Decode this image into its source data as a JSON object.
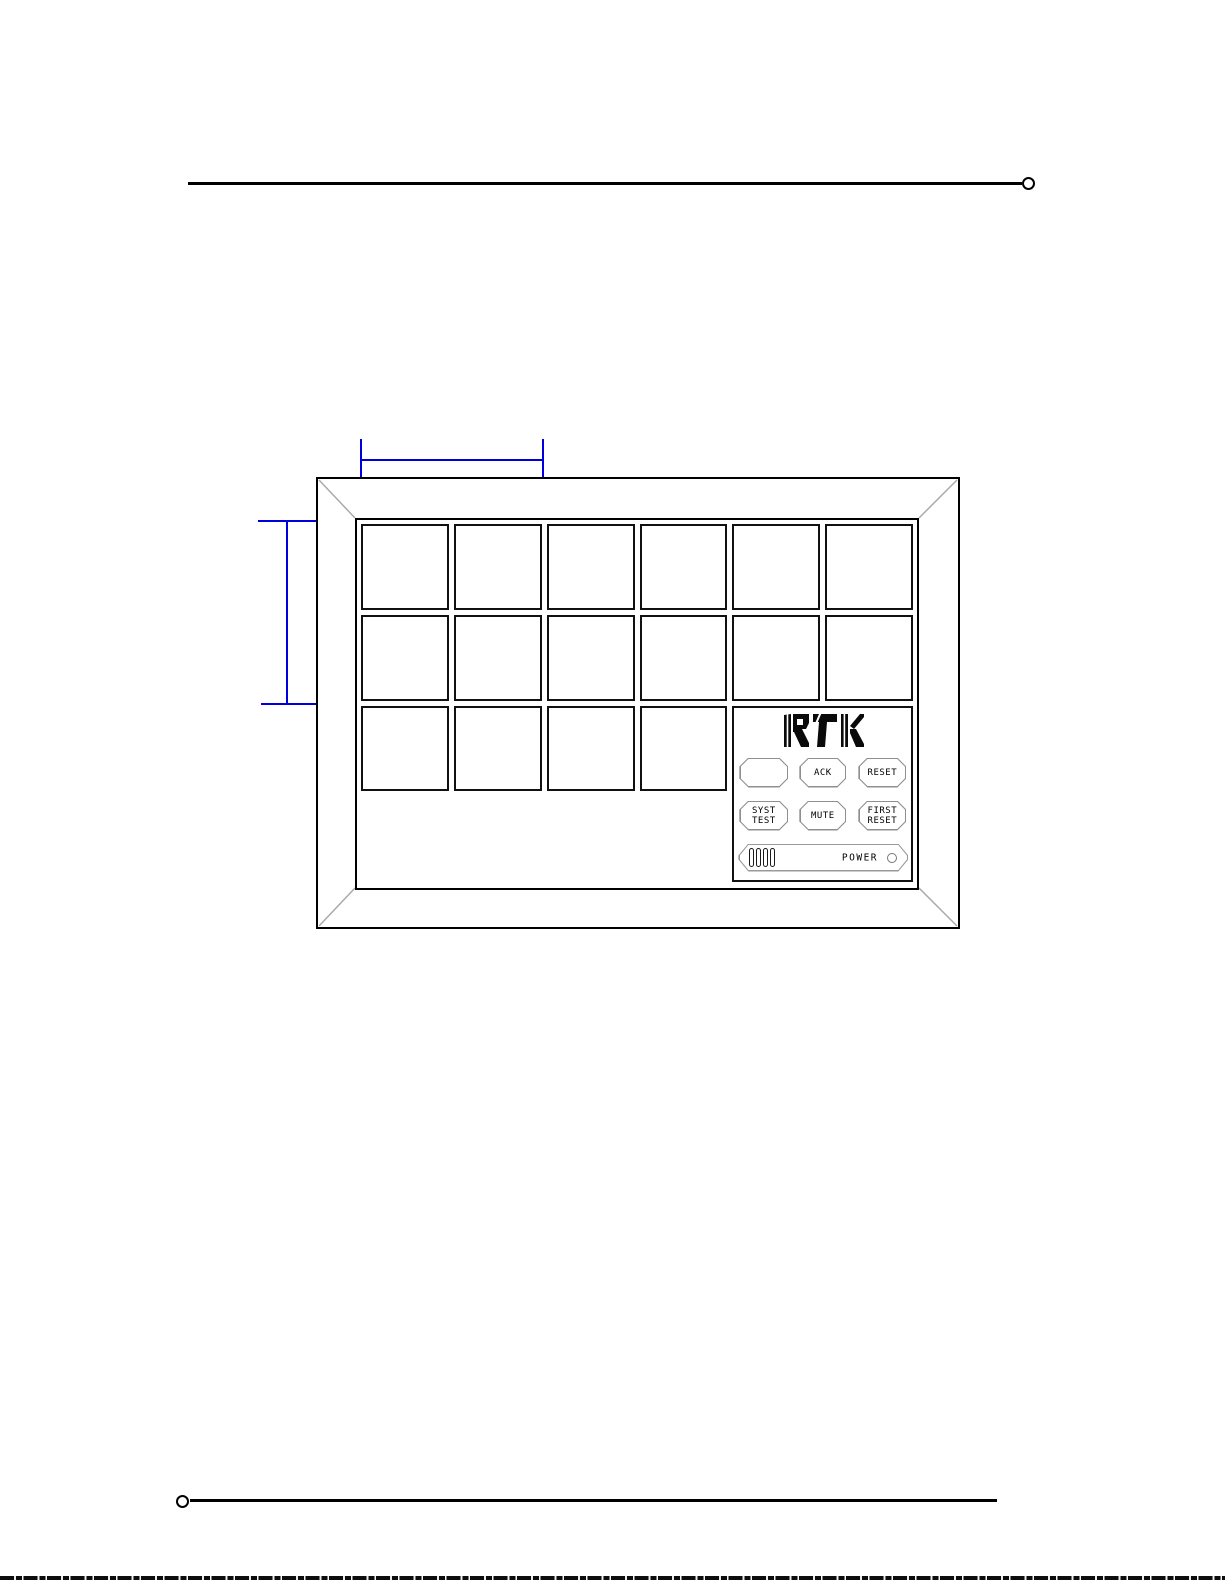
{
  "document": {
    "figure": {
      "panel": {
        "brand_logo": "RTK",
        "windows": {
          "columns": 6,
          "rows": 4,
          "top_windows": 12,
          "bottom_windows": 8
        },
        "buttons": {
          "blank": "",
          "ack": "ACK",
          "reset": "RESET",
          "syst_test": [
            "SYST",
            "TEST"
          ],
          "mute": "MUTE",
          "first_reset": [
            "FIRST",
            "RESET"
          ]
        },
        "power_label": "POWER"
      },
      "colors": {
        "dimension_line": "#0000dd",
        "drawing_line": "#000000",
        "bevel_line": "#aaaaaa",
        "button_outline": "#8f8f8f"
      }
    }
  }
}
